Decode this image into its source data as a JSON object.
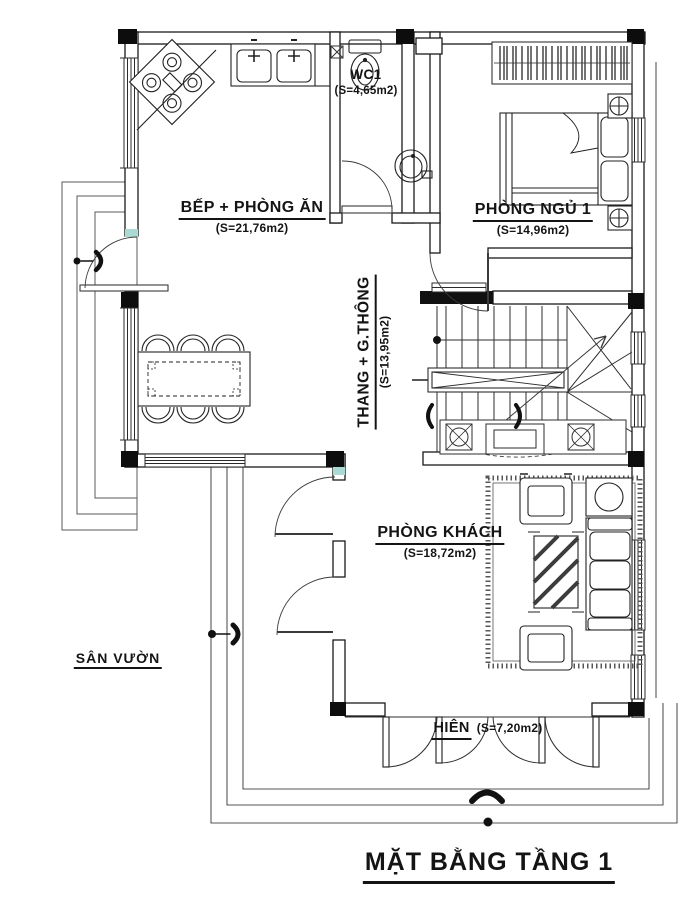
{
  "title": {
    "text": "MẶT BẰNG TẦNG 1"
  },
  "rooms": {
    "kitchen_dining": {
      "name": "BẾP + PHÒNG ĂN",
      "area": "(S=21,76m2)"
    },
    "wc1": {
      "name": "WC1",
      "area": "(S=4,65m2)"
    },
    "bedroom1": {
      "name": "PHÒNG NGỦ 1",
      "area": "(S=14,96m2)"
    },
    "stairs": {
      "name": "THANG + G.THÔNG",
      "area": "(S=13,95m2)"
    },
    "living": {
      "name": "PHÒNG KHÁCH",
      "area": "(S=18,72m2)"
    },
    "porch": {
      "name": "HIÊN",
      "area": "(S=7,20m2)"
    }
  },
  "outdoor": {
    "garden": {
      "name": "SÂN VƯỜN"
    }
  },
  "colors": {
    "ink": "#1a1a1a",
    "paper": "#ffffff",
    "accent_teal": "#a9dbd4",
    "light_line": "#6e6e6e"
  }
}
